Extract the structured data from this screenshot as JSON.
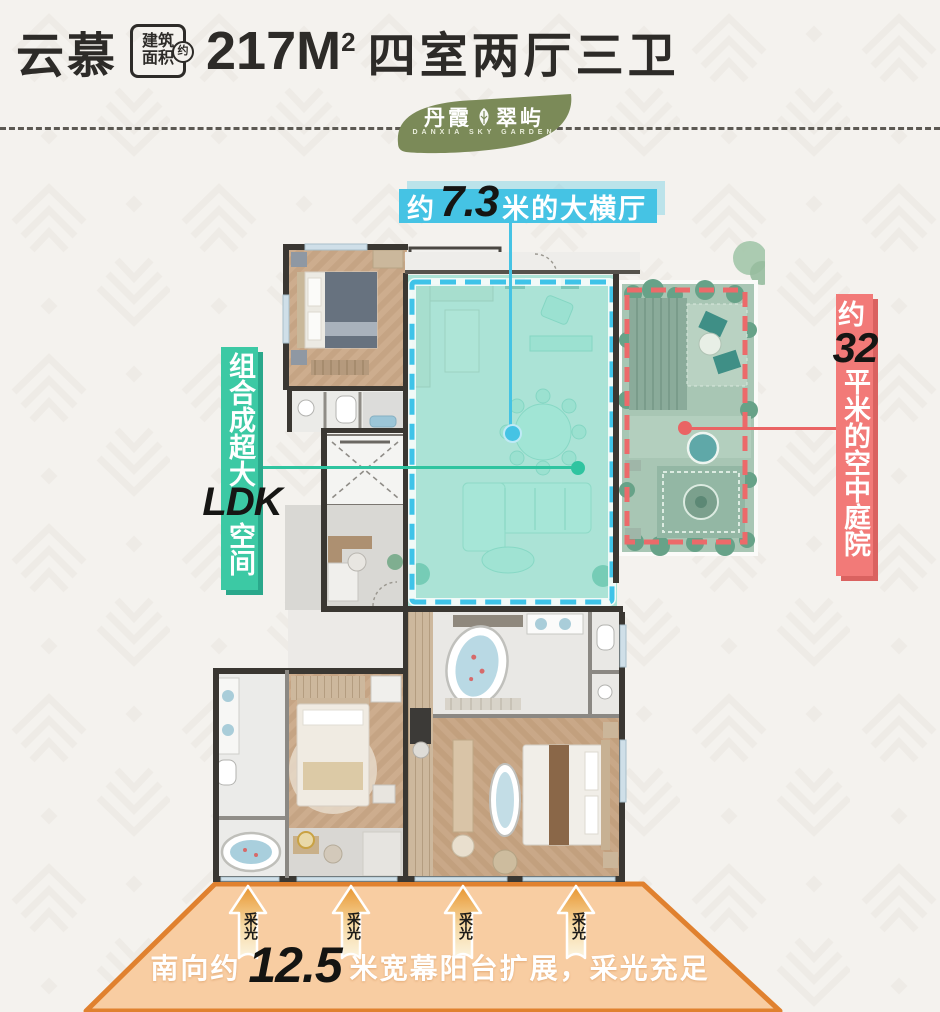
{
  "header": {
    "product_name": "云慕",
    "area_badge": {
      "line1": "建筑",
      "line2": "面积",
      "approx": "约"
    },
    "area_value": "217M",
    "area_sup": "2",
    "layout_text": "四室两厅三卫"
  },
  "logo": {
    "name_left": "丹霞",
    "name_right": "翠屿",
    "subtitle": "DANXIA SKY GARDEN"
  },
  "annotations": {
    "hall": {
      "prefix": "约",
      "value": "7.3",
      "suffix": "米的大横厅"
    },
    "ldk": {
      "top": "组合成超大",
      "highlight": "LDK",
      "bottom": "空间"
    },
    "courtyard": {
      "prefix": "约",
      "value": "32",
      "suffix": "平米的空中庭院"
    }
  },
  "balcony": {
    "arrow_label": "采光",
    "text_prefix": "南向约",
    "text_value": "12.5",
    "text_suffix": "米宽幕阳台扩展，采光充足"
  },
  "colors": {
    "hall_accent": "#45c3e4",
    "ldk_accent": "#3cc9a4",
    "courtyard_accent": "#f27a78",
    "balcony_fill": "#f8cda2",
    "balcony_border": "#e0812f",
    "logo_green": "#7b8a58",
    "title_ink": "#2d2b28"
  }
}
